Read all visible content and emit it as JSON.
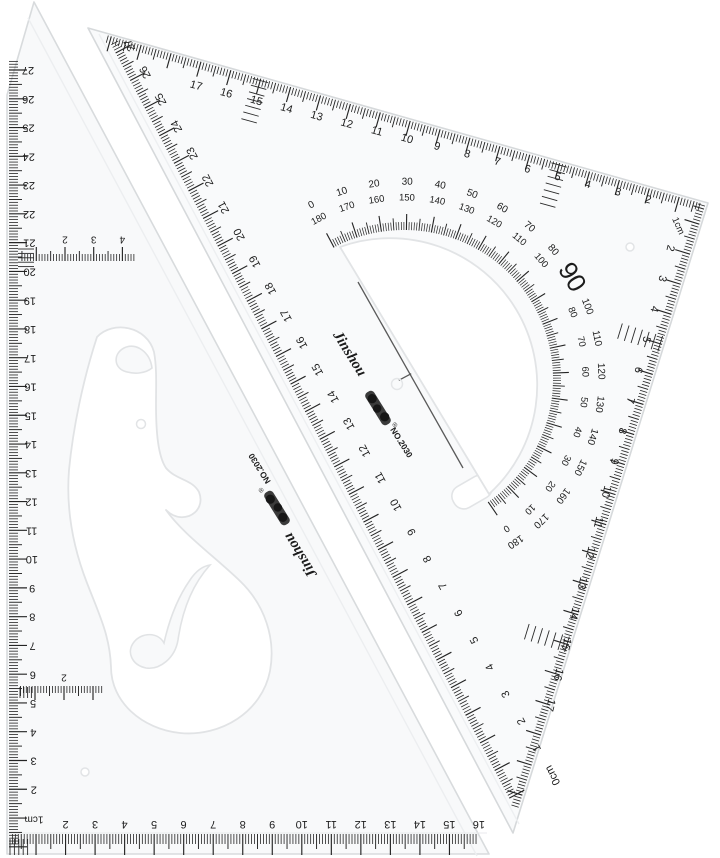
{
  "colors": {
    "background": "#ffffff",
    "ink": "#1c1c1c",
    "plastic_edge": "#d7dadc",
    "plastic_fill": "#f8f9fa"
  },
  "big_triangle": {
    "brand": {
      "name": "Jinshou",
      "registered": "®",
      "model": "NO.2030"
    },
    "scales": {
      "hypotenuse_numbers": [
        "27",
        "26",
        "25",
        "24",
        "23",
        "22",
        "21",
        "20",
        "19",
        "18",
        "17",
        "16",
        "15",
        "14",
        "13",
        "12",
        "11",
        "10",
        "9",
        "8",
        "7",
        "6",
        "5",
        "4",
        "3",
        "2",
        "1",
        "0cm"
      ],
      "top_numbers": [
        "17",
        "16",
        "15",
        "14",
        "13",
        "12",
        "11",
        "10",
        "9",
        "8",
        "7",
        "6",
        "5",
        "4",
        "3",
        "2"
      ],
      "right_numbers": [
        "2",
        "3",
        "4",
        "5",
        "6",
        "7",
        "8",
        "9",
        "10",
        "11",
        "12",
        "13",
        "14",
        "15",
        "16",
        "17"
      ],
      "corner_unit": "1cm"
    },
    "protractor": {
      "outer_degrees": [
        "0",
        "10",
        "20",
        "30",
        "40",
        "50",
        "60",
        "70",
        "80",
        "90",
        "100",
        "110",
        "120",
        "130",
        "140",
        "150",
        "160",
        "170",
        "180"
      ],
      "inner_degrees": [
        "180",
        "170",
        "160",
        "150",
        "140",
        "130",
        "120",
        "110",
        "100",
        "",
        "80",
        "70",
        "60",
        "50",
        "40",
        "30",
        "20",
        "10",
        "0"
      ]
    }
  },
  "curve_triangle": {
    "brand": {
      "name": "Jinshou",
      "registered": "®",
      "model": "NO.2030"
    },
    "scales": {
      "left_numbers": [
        "27",
        "26",
        "25",
        "24",
        "23",
        "22",
        "21",
        "20",
        "19",
        "18",
        "17",
        "16",
        "15",
        "14",
        "13",
        "12",
        "11",
        "10",
        "9",
        "8",
        "7",
        "6",
        "5",
        "4",
        "3",
        "2"
      ],
      "bottom_numbers": [
        "2",
        "3",
        "4",
        "5",
        "6",
        "7",
        "8",
        "9",
        "10",
        "11",
        "12",
        "13",
        "14",
        "15",
        "16"
      ],
      "corner_unit": "1cm",
      "inner_top_numbers": [
        "2",
        "3",
        "4"
      ],
      "inner_bottom_numbers": [
        "2"
      ]
    }
  }
}
